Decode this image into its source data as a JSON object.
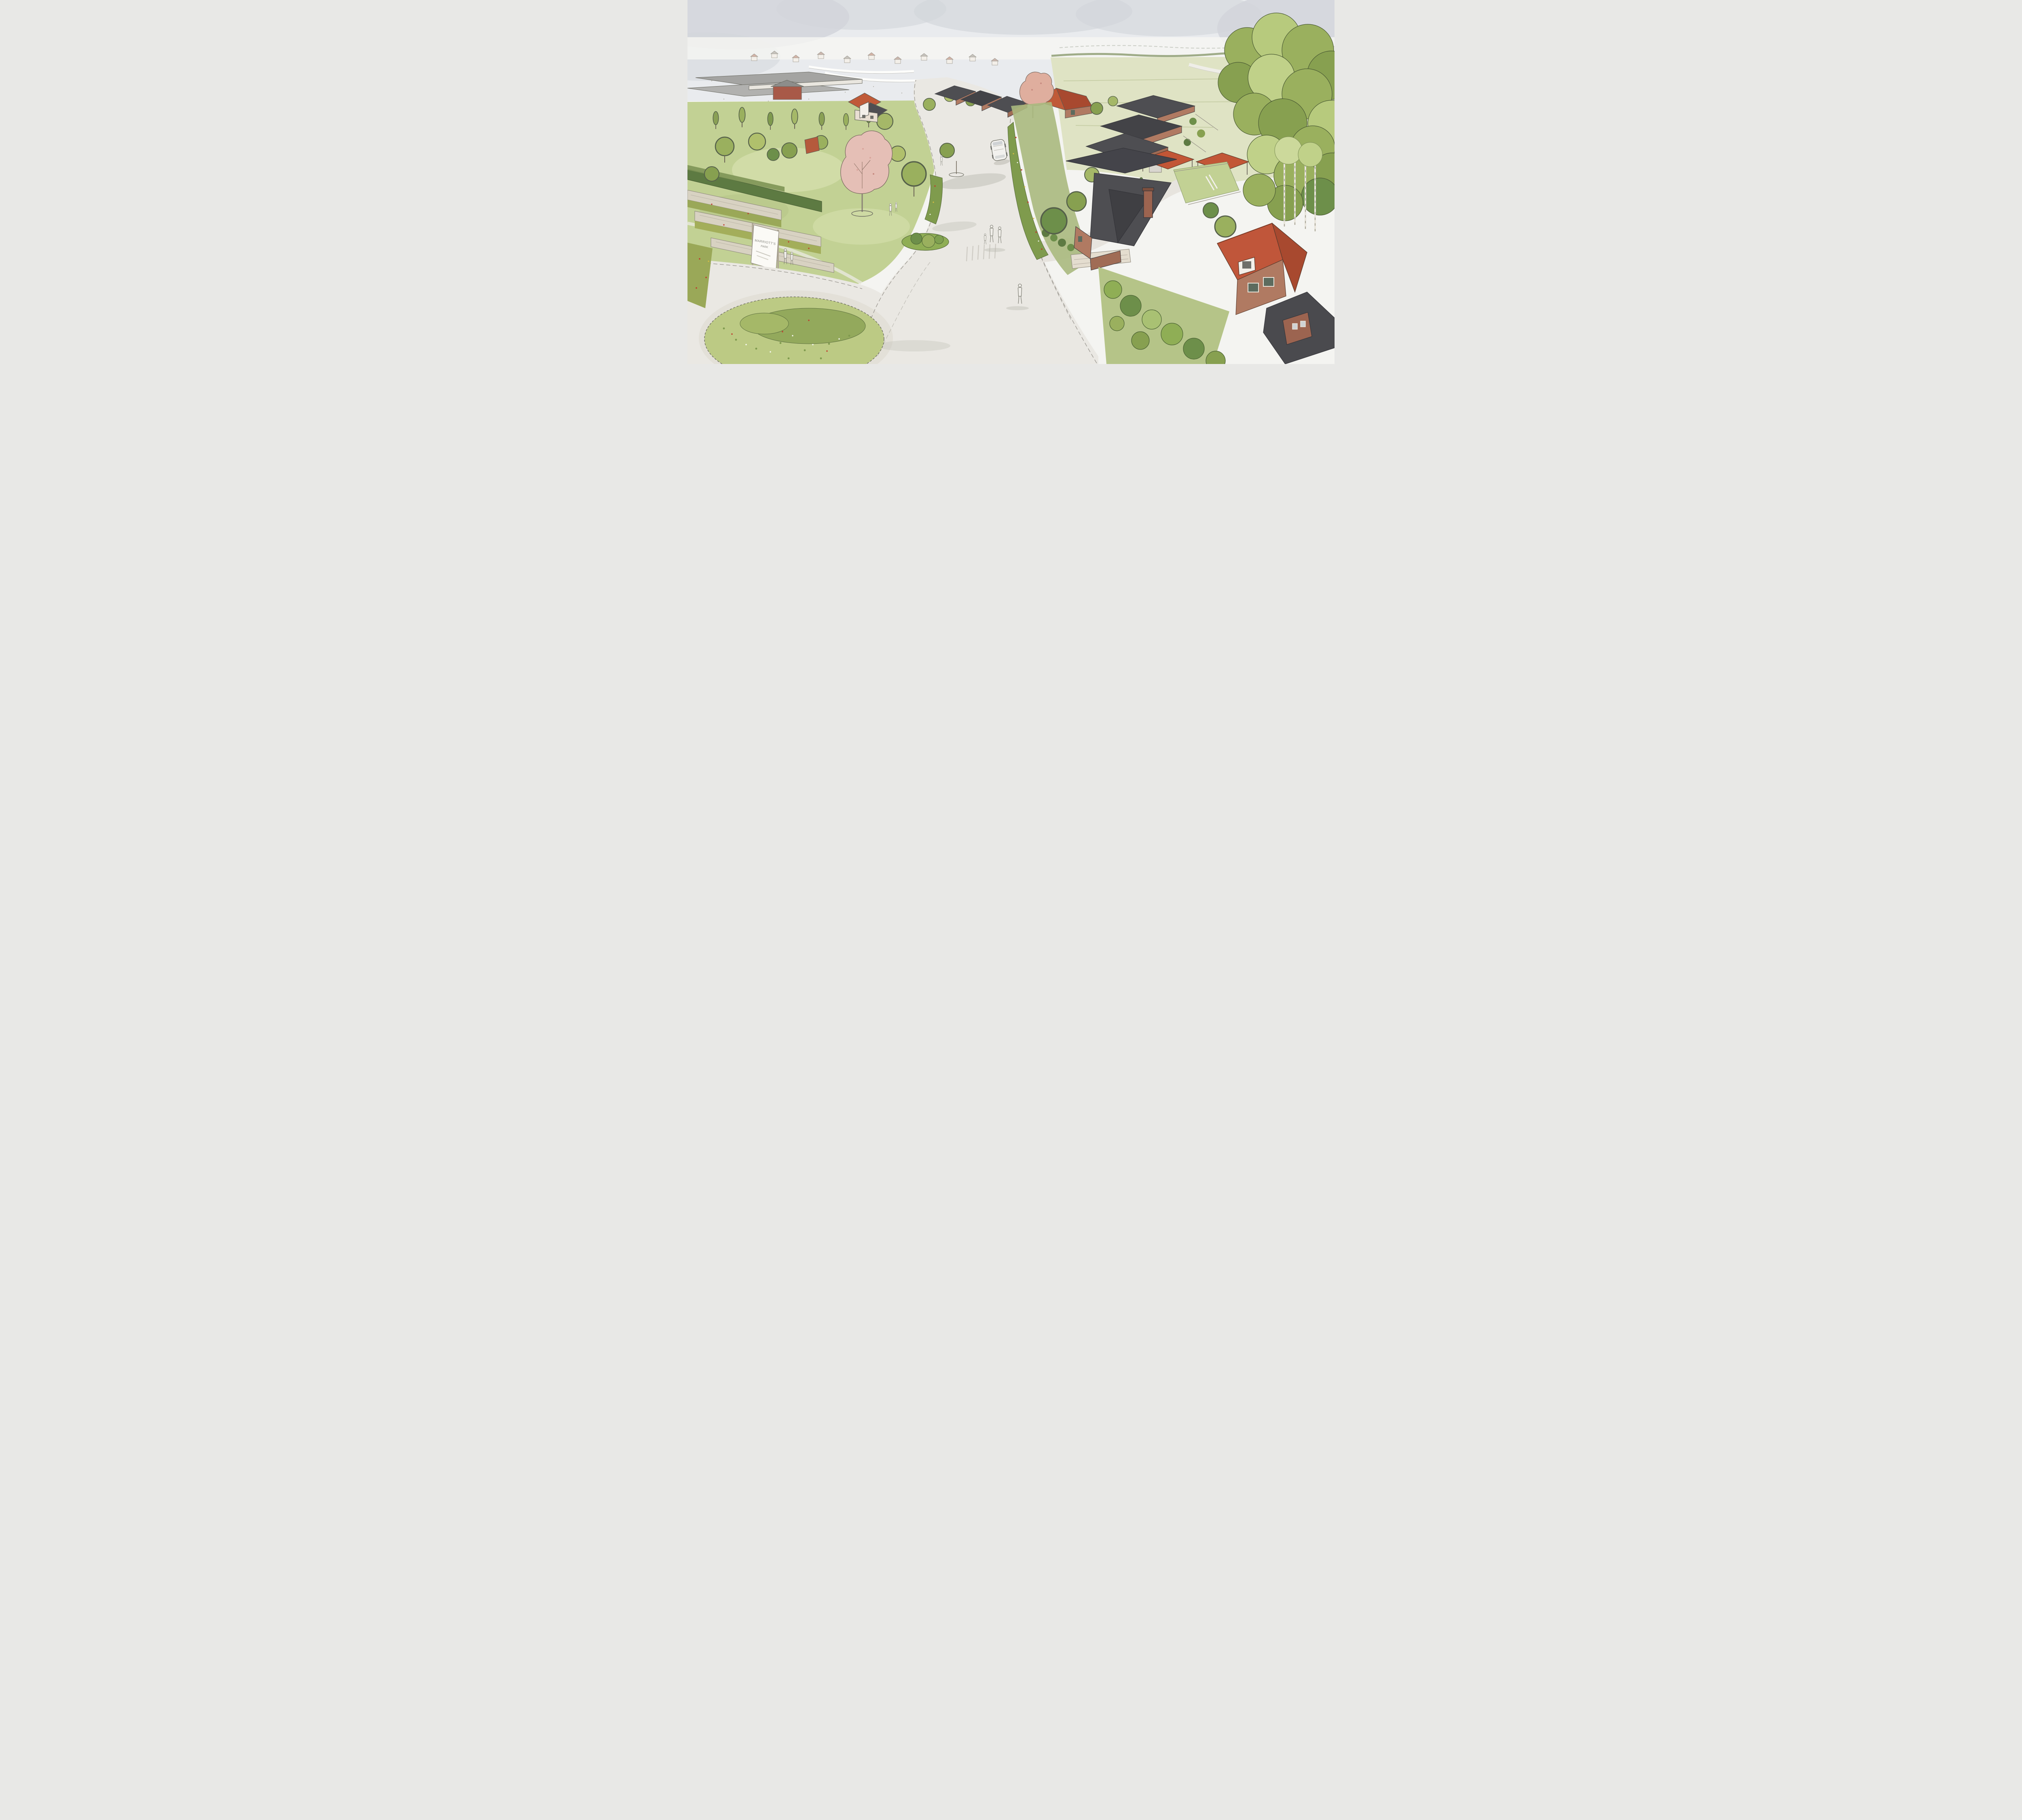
{
  "scene": {
    "type": "watercolour architectural aerial illustration",
    "description": "Artist impression of a new residential neighbourhood: a curving avenue with wildflower verges and a planted roundabout leads past single-storey bungalows and detached brick houses with slate and terracotta roofs; sketched pedestrians and a white car use the street; gabion planters and an entrance sign mark the gateway; woodland frames the right edge with a sketched town on the horizon."
  },
  "entrance_sign": {
    "line1": "MARRIOTT'S",
    "line2": "PARK"
  },
  "palette": {
    "paper": "#f4f4f1",
    "sky_wash": "#e9ebee",
    "cloud_grey": "#d2d5da",
    "ink": "#5a5a52",
    "road": "#eae8e3",
    "road_shadow": "#b9b9ae",
    "kerb": "#8b8780",
    "grass_light": "#d6dfae",
    "grass_mid": "#c2d194",
    "grass_olive": "#aab97e",
    "meadow_pale": "#dfe3c4",
    "hedge_dark": "#5d7a42",
    "tree_green": "#9ab05e",
    "tree_light": "#c0d189",
    "tree_dark": "#6d8f4a",
    "blossom_pink": "#e5bfb6",
    "blossom_deep": "#d9a49b",
    "brick": "#b07a62",
    "brick_red": "#a85948",
    "roof_slate": "#4e4e52",
    "roof_slate_dark": "#3f3f43",
    "roof_terracotta": "#c05a38",
    "roof_terracotta_dark": "#a8492f",
    "gabion_stone": "#d8d2c2",
    "sign_white": "#fbfaf6",
    "car_white": "#f2f1ee",
    "figure_grey": "#efede8"
  }
}
